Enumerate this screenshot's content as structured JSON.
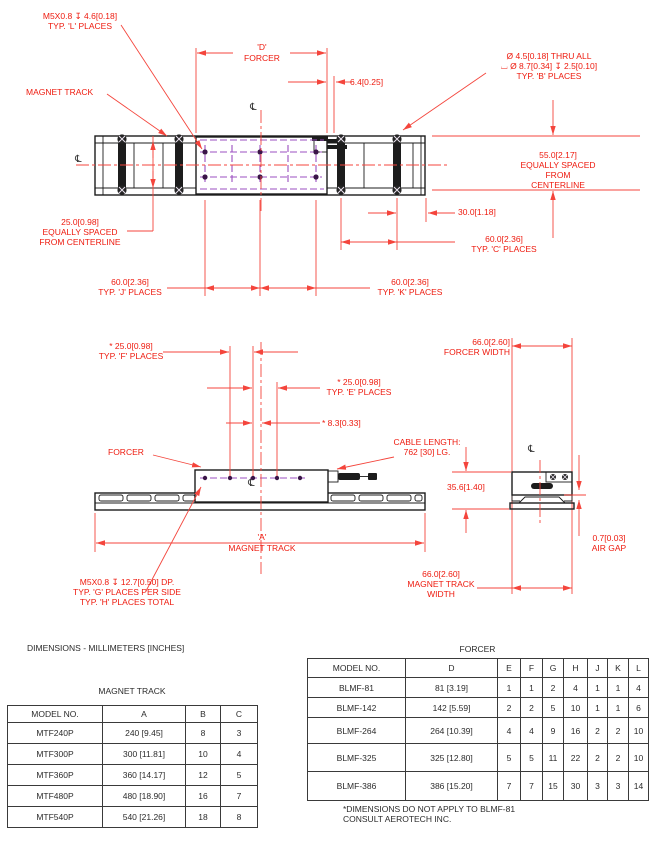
{
  "drawing": {
    "centerline_symbol": "℄",
    "view_top": {
      "note_tap_forcer": "M5X0.8 ↧ 4.6[0.18]\nTYP. 'L' PLACES",
      "magnet_track_label": "MAGNET TRACK",
      "dim_d": "'D'\nFORCER",
      "dim_6_4": "6.4[0.25]",
      "note_cbore": "Ø 4.5[0.18] THRU ALL\n⌴ Ø 8.7[0.34] ↧ 2.5[0.10]\nTYP. 'B' PLACES",
      "dim_55": "55.0[2.17]\nEQUALLY SPACED\nFROM CENTERLINE",
      "dim_25": "25.0[0.98]\nEQUALLY SPACED\nFROM CENTERLINE",
      "dim_30": "30.0[1.18]",
      "dim_60_c": "60.0[2.36]\nTYP. 'C' PLACES",
      "dim_60_j": "60.0[2.36]\nTYP. 'J' PLACES",
      "dim_60_k": "60.0[2.36]\nTYP. 'K' PLACES"
    },
    "view_side": {
      "dim_f": "* 25.0[0.98]\nTYP. 'F' PLACES",
      "dim_e": "* 25.0[0.98]\nTYP. 'E' PLACES",
      "dim_8_3": "* 8.3[0.33]",
      "forcer_label": "FORCER",
      "cable_note": "CABLE LENGTH:\n762 [30] LG.",
      "dim_a": "'A'\nMAGNET TRACK",
      "note_tap_track": "M5X0.8 ↧ 12.7[0.50] DP.\nTYP. 'G' PLACES PER SIDE\nTYP. 'H' PLACES TOTAL",
      "dim_forcer_width": "66.0[2.60]\nFORCER WIDTH",
      "dim_35_6": "35.6[1.40]",
      "dim_air_gap": "0.7[0.03]\nAIR GAP",
      "dim_track_width": "66.0[2.60]\nMAGNET TRACK\nWIDTH"
    }
  },
  "units_note": "DIMENSIONS - MILLIMETERS [INCHES]",
  "tables": {
    "magnet_track": {
      "title": "MAGNET TRACK",
      "headers": [
        "MODEL NO.",
        "A",
        "B",
        "C"
      ],
      "rows": [
        [
          "MTF240P",
          "240 [9.45]",
          "8",
          "3"
        ],
        [
          "MTF300P",
          "300 [11.81]",
          "10",
          "4"
        ],
        [
          "MTF360P",
          "360 [14.17]",
          "12",
          "5"
        ],
        [
          "MTF480P",
          "480 [18.90]",
          "16",
          "7"
        ],
        [
          "MTF540P",
          "540 [21.26]",
          "18",
          "8"
        ]
      ]
    },
    "forcer": {
      "title": "FORCER",
      "headers": [
        "MODEL NO.",
        "D",
        "E",
        "F",
        "G",
        "H",
        "J",
        "K",
        "L"
      ],
      "rows": [
        [
          "BLMF-81",
          "81 [3.19]",
          "1",
          "1",
          "2",
          "4",
          "1",
          "1",
          "4"
        ],
        [
          "BLMF-142",
          "142 [5.59]",
          "2",
          "2",
          "5",
          "10",
          "1",
          "1",
          "6"
        ],
        [
          "BLMF-264",
          "264 [10.39]",
          "4",
          "4",
          "9",
          "16",
          "2",
          "2",
          "10"
        ],
        [
          "BLMF-325",
          "325 [12.80]",
          "5",
          "5",
          "11",
          "22",
          "2",
          "2",
          "10"
        ],
        [
          "BLMF-386",
          "386 [15.20]",
          "7",
          "7",
          "15",
          "30",
          "3",
          "3",
          "14"
        ]
      ]
    },
    "footnote": "*DIMENSIONS DO NOT APPLY TO BLMF-81\nCONSULT AEROTECH INC."
  },
  "colors": {
    "dimension_red": "#ee1a0e",
    "hidden_purple": "#9b4fc0",
    "line_black": "#1c1c1c"
  }
}
